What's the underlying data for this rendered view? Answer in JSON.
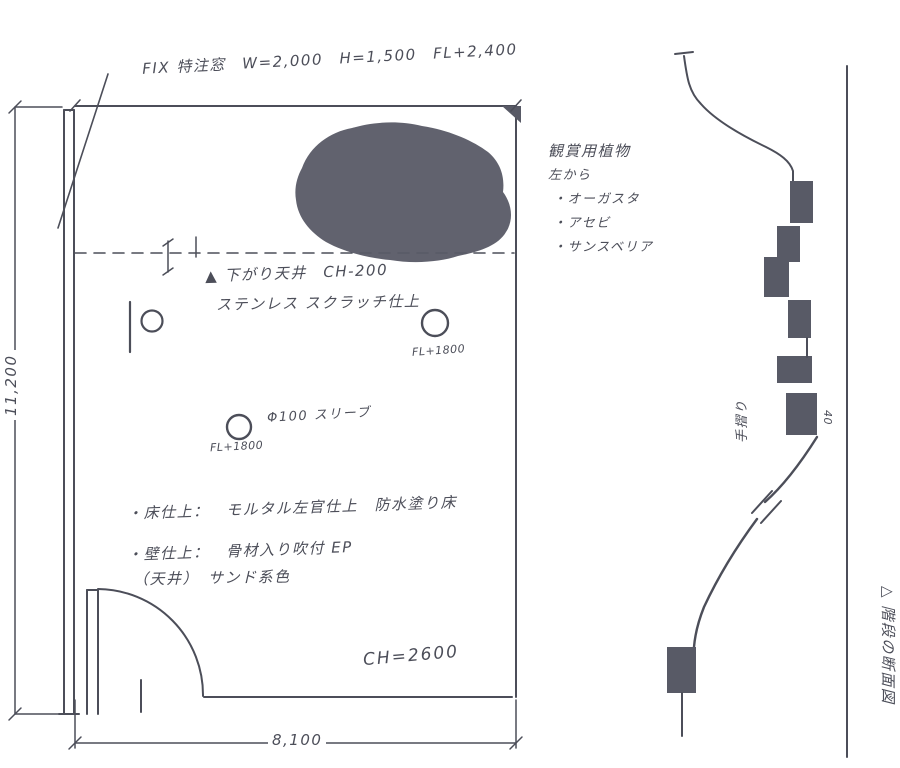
{
  "ink": "#4c4e59",
  "fill": "#585a66",
  "plan": {
    "window_note": "FIX 特注窓　W=2,000　H=1,500　FL+2,400",
    "drop_ceiling_note": "▲ 下がり天井　CH-200",
    "drop_ceiling_finish": "ステンレス スクラッチ仕上",
    "downlight_level_a": "FL+1800",
    "sleeve_note": "Φ100 スリーブ",
    "downlight_level_b": "FL+1800",
    "floor_finish_note": "・床仕上：　モルタル左官仕上　防水塗り床",
    "wall_finish_note": "・壁仕上：　骨材入り吹付 EP",
    "wall_finish_note2": "（天井）　サンド系色",
    "ceiling_height": "CH=2600",
    "width_dim": "8,100",
    "height_dim": "11,200"
  },
  "plants": {
    "title": "観賞用植物",
    "from_left": "左から",
    "items": [
      {
        "label": "・オーガスタ"
      },
      {
        "label": "・アセビ"
      },
      {
        "label": "・サンスベリア"
      }
    ]
  },
  "section": {
    "handrail": "手摺り",
    "riser_dim": "40",
    "caption": "△ 階段の断面図"
  }
}
